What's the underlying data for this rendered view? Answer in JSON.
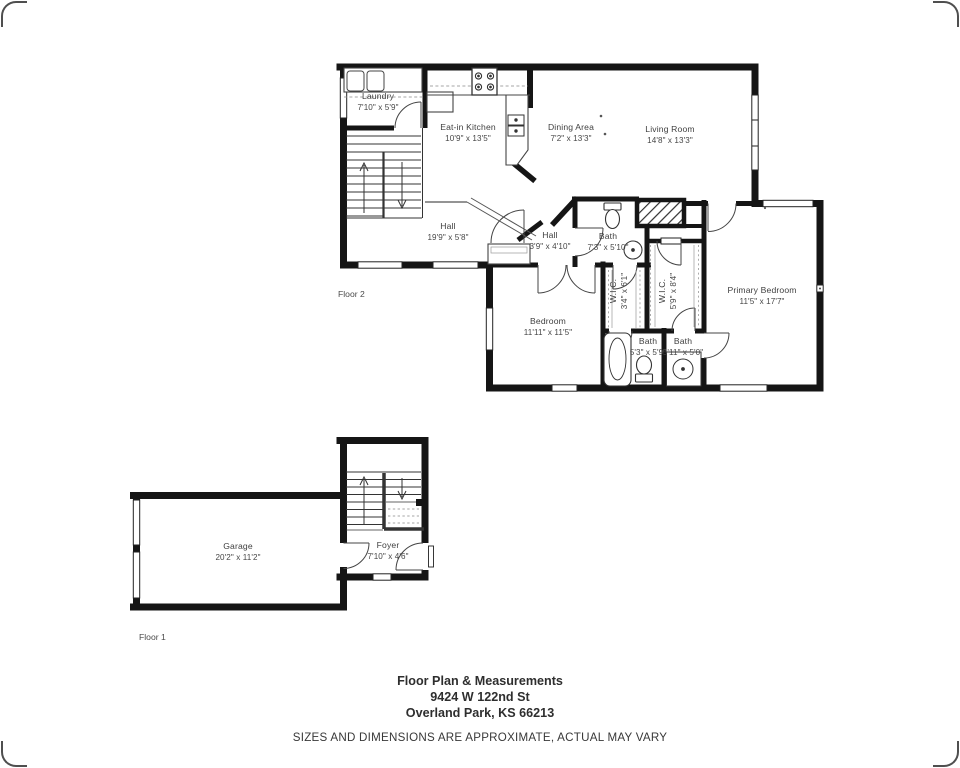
{
  "floor2": {
    "label": "Floor 2",
    "rooms": {
      "laundry": {
        "name": "Laundry",
        "dims": "7'10\" x 5'9\""
      },
      "kitchen": {
        "name": "Eat-in Kitchen",
        "dims": "10'9\" x 13'5\""
      },
      "dining": {
        "name": "Dining Area",
        "dims": "7'2\" x 13'3\""
      },
      "living": {
        "name": "Living Room",
        "dims": "14'8\" x 13'3\""
      },
      "hall_main": {
        "name": "Hall",
        "dims": "19'9\" x 5'8\""
      },
      "hall_small": {
        "name": "Hall",
        "dims": "3'9\" x 4'10\""
      },
      "bath_main": {
        "name": "Bath",
        "dims": "7'3\" x 5'10\""
      },
      "wic_small": {
        "name": "W.I.C.",
        "dims": "3'4\" x 6'1\""
      },
      "wic_large": {
        "name": "W.I.C.",
        "dims": "5'9\" x 8'4\""
      },
      "bedroom": {
        "name": "Bedroom",
        "dims": "11'11\" x 11'5\""
      },
      "primary": {
        "name": "Primary Bedroom",
        "dims": "11'5\" x 17'7\""
      },
      "bath_left": {
        "name": "Bath",
        "dims": "5'3\" x 5'9\""
      },
      "bath_right": {
        "name": "Bath",
        "dims": "5'11\" x 5'0\""
      }
    }
  },
  "floor1": {
    "label": "Floor 1",
    "rooms": {
      "garage": {
        "name": "Garage",
        "dims": "20'2\" x 11'2\""
      },
      "foyer": {
        "name": "Foyer",
        "dims": "7'10\" x 4'6\""
      }
    }
  },
  "footer": {
    "title": "Floor Plan & Measurements",
    "address_line1": "9424 W 122nd St",
    "address_line2": "Overland Park, KS  66213",
    "disclaimer": "SIZES AND DIMENSIONS ARE APPROXIMATE, ACTUAL MAY VARY"
  },
  "fixtures": [
    "stairs-icon",
    "stove-icon",
    "kitchen-sink-icon",
    "toilet-icon",
    "pedestal-sink-icon",
    "bathtub-icon",
    "shower-icon",
    "closet-icon",
    "washer-dryer-icon"
  ],
  "colors": {
    "wall": "#151515",
    "label_text": "#3f3f3f",
    "background": "#ffffff"
  }
}
